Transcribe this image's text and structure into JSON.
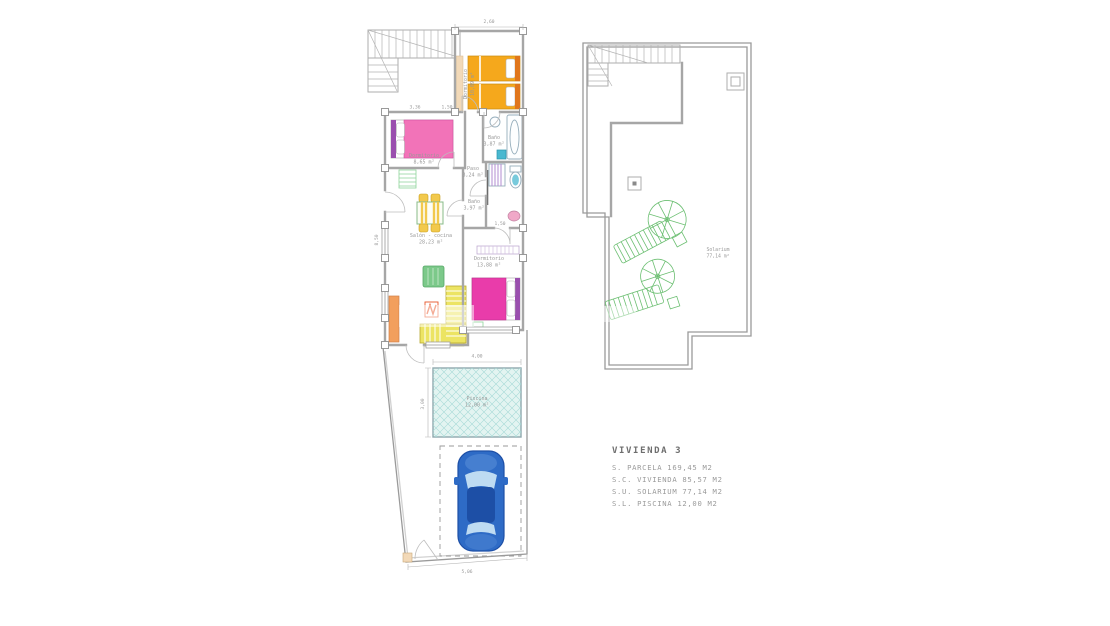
{
  "legend": {
    "title": "VIVIENDA  3",
    "rows": [
      "S.  PARCELA  169,45  M2",
      "S.C.  VIVIENDA  85,57  M2",
      "S.U.  SOLARIUM  77,14  M2",
      "S.L.  PISCINA  12,00  M2"
    ]
  },
  "floor_plan": {
    "rooms": {
      "dormitorio_1": {
        "label": "Dormitorio",
        "area": "10,09 m²"
      },
      "dormitorio_2": {
        "label": "Dormitorio",
        "area": "8,65 m²"
      },
      "bano_1": {
        "label": "Baño",
        "area": "3,87 m²"
      },
      "paso": {
        "label": "Paso",
        "area": "3,24 m²"
      },
      "salon_cocina": {
        "label": "Salón - cocina",
        "area": "28,23 m²"
      },
      "bano_2": {
        "label": "Baño",
        "area": "3,97 m²"
      },
      "dormitorio_3": {
        "label": "Dormitorio",
        "area": "13,88 m²"
      },
      "piscina": {
        "label": "Piscina",
        "area": "12,00 m²"
      }
    },
    "dimensions": {
      "top_width": "2,60",
      "bedroom2_width": "3,36",
      "paso_width": "1,50",
      "left_height": "8,50",
      "bath2_width": "1,50",
      "pool_width": "4,00",
      "pool_depth": "3,00",
      "bottom_width": "5,06"
    }
  },
  "solarium_plan": {
    "room": {
      "label": "Solarium",
      "area": "77,14 m²"
    }
  },
  "watermark": {
    "text": "M"
  },
  "colors": {
    "wall": "#a6a6a6",
    "wall_fill": "#f2d9b8",
    "text": "#999999",
    "legend_title": "#6e6e6e",
    "legend_text": "#9a9a9a",
    "bed_orange": "#f5a81c",
    "bed_orange_dark": "#e0761c",
    "bed_pink": "#f273b8",
    "bed_magenta": "#e93caa",
    "headboard_purple": "#9a4fae",
    "chair_yellow": "#f2c94c",
    "sofa_green": "#7cc98a",
    "counter_yellow": "#ece463",
    "counter_orange": "#f29f5d",
    "appliance_red": "#e8562a",
    "rug_green": "#8fd49b",
    "fixture_blue": "#49b8d0",
    "fixture_pink": "#f0a8c8",
    "shower_purple": "#b48cd0",
    "pool_fill": "#e3f4f1",
    "pool_hatch": "#a6d9d6",
    "car_body": "#2e6bc6",
    "car_dark": "#1d4fa6",
    "car_glass": "#bedbf2",
    "solarium_green": "#6cbf72"
  }
}
